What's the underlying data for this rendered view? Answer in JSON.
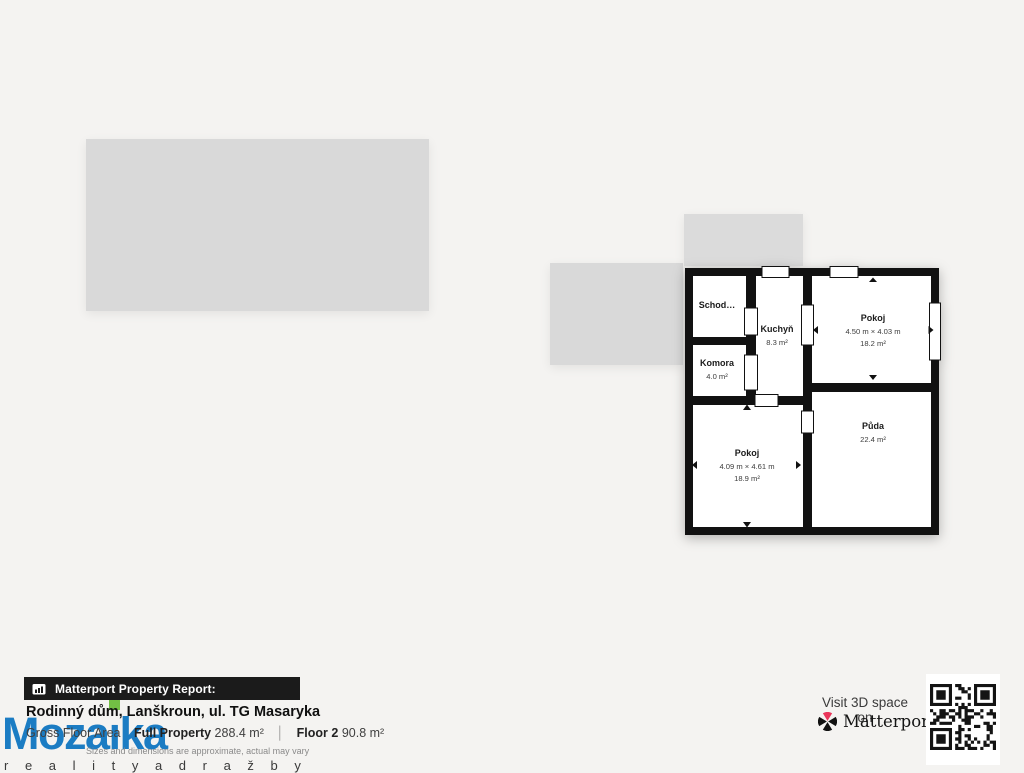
{
  "background_color": "#f4f3f1",
  "floorplan": {
    "wall_color": "#111111",
    "floor_fill": "#ffffff",
    "rooms": [
      {
        "name": "Schod…"
      },
      {
        "name": "Kuchyň",
        "area": "8.3 m²"
      },
      {
        "name": "Pokoj",
        "dims": "4.50 m × 4.03 m",
        "area": "18.2 m²"
      },
      {
        "name": "Komora",
        "area": "4.0 m²"
      },
      {
        "name": "Pokoj",
        "dims": "4.09 m × 4.61 m",
        "area": "18.9 m²"
      },
      {
        "name": "Půda",
        "area": "22.4 m²"
      }
    ]
  },
  "report": {
    "bar_label": "Matterport Property Report:",
    "title": "Rodinný dům, Lanškroun, ul. TG Masaryka",
    "stats": {
      "area_label": "Gross Floor Area",
      "full_property_label": "Full Property",
      "full_property_value": "288.4 m²",
      "divider": "│",
      "floor_label": "Floor 2",
      "floor_value": "90.8 m²"
    },
    "disclaimer": "Sizes and dimensions are approximate, actual may vary"
  },
  "brand": {
    "name": "Mozaika",
    "display_pre": "Moza",
    "display_i": "ı",
    "display_post": "ka",
    "tagline": "r e a l i t y   a   d r a ž b y",
    "blue": "#1b7cc3",
    "green": "#72bf44"
  },
  "matterport": {
    "visit_label": "Visit 3D space on",
    "wordmark": "Matterport",
    "trademark": "®",
    "logo_red": "#e9365a",
    "logo_black": "#111111"
  }
}
